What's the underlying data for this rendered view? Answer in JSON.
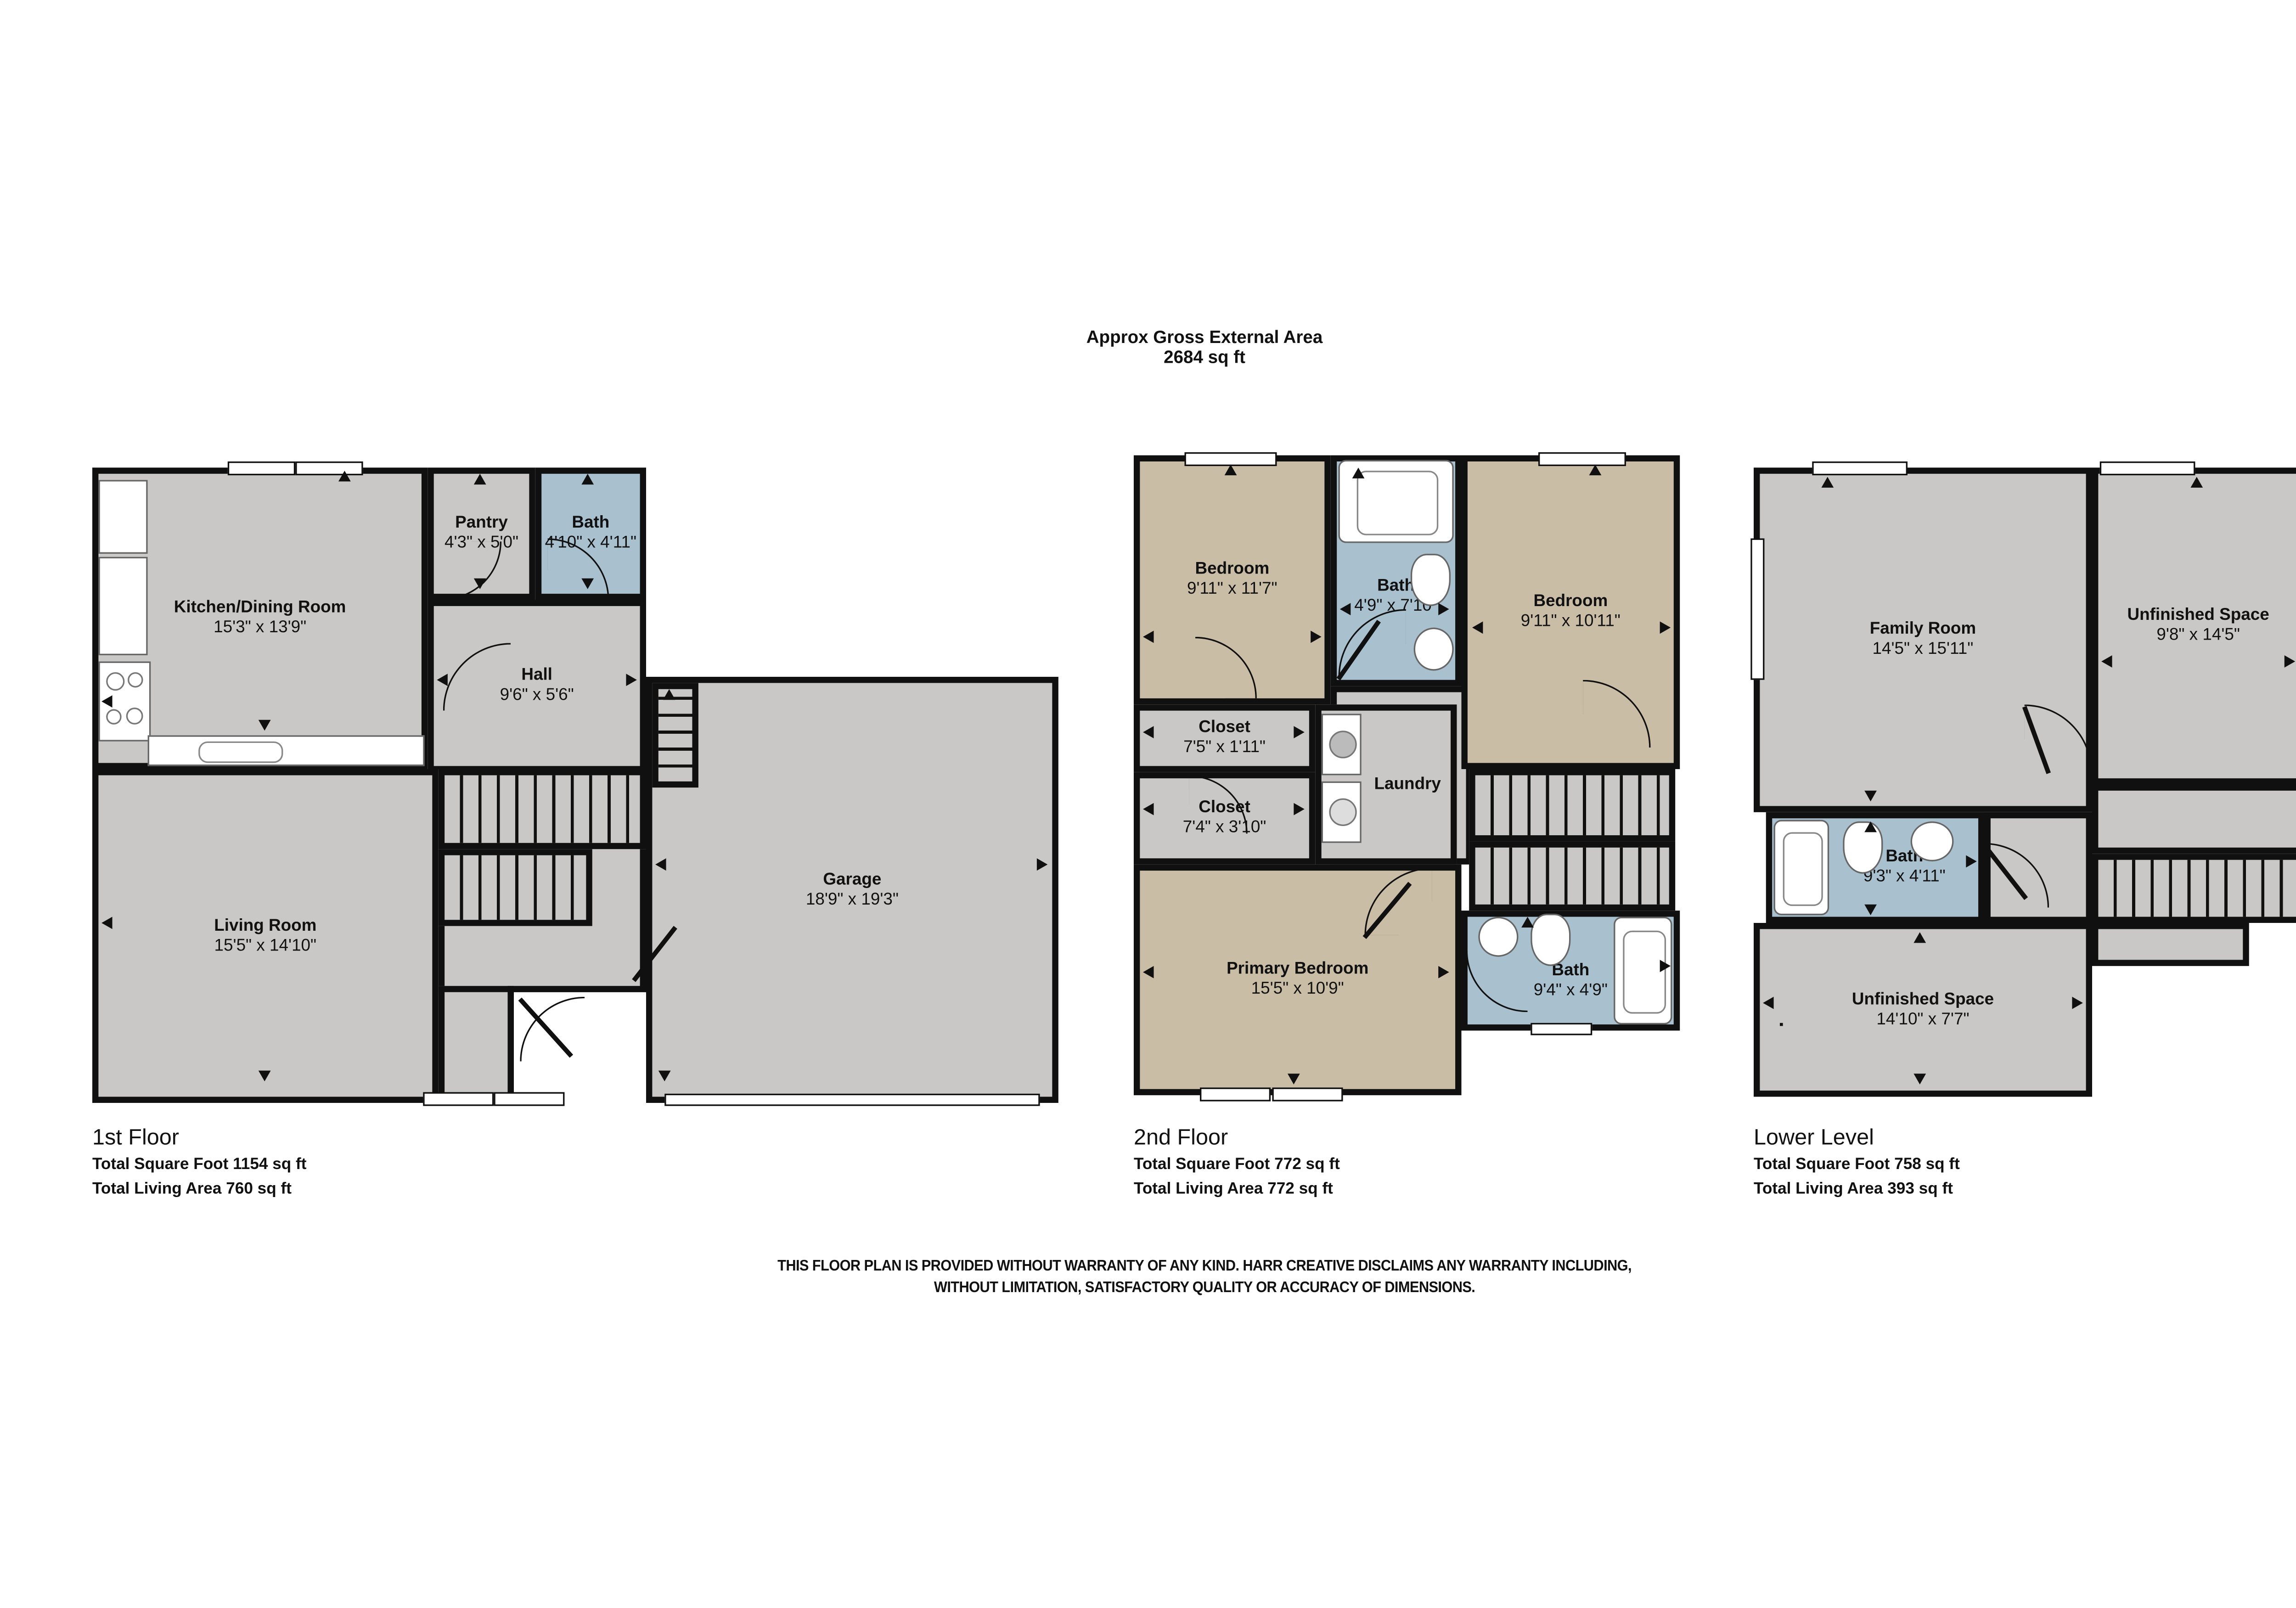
{
  "title": {
    "line1": "Approx Gross External Area",
    "line2": "2684 sq ft"
  },
  "disclaimer": {
    "line1": "THIS FLOOR PLAN IS PROVIDED WITHOUT WARRANTY OF ANY KIND. HARR CREATIVE DISCLAIMS ANY WARRANTY INCLUDING,",
    "line2": "WITHOUT LIMITATION, SATISFACTORY QUALITY OR ACCURACY OF DIMENSIONS."
  },
  "colors": {
    "wall": "#101010",
    "room_gray": "#c9c8c6",
    "room_tan": "#c9bda6",
    "room_blue": "#a9c0ce",
    "window_white": "#ffffff"
  },
  "floors": [
    {
      "name": "1st Floor",
      "total_sqft": "Total Square Foot 1154 sq ft",
      "living_area": "Total Living Area 760 sq ft",
      "rooms": {
        "kitchen": {
          "label": "Kitchen/Dining Room",
          "dims": "15'3\" x 13'9\""
        },
        "pantry": {
          "label": "Pantry",
          "dims": "4'3\" x 5'0\""
        },
        "bath": {
          "label": "Bath",
          "dims": "4'10\" x 4'11\""
        },
        "hall": {
          "label": "Hall",
          "dims": "9'6\" x 5'6\""
        },
        "living": {
          "label": "Living Room",
          "dims": "15'5\" x 14'10\""
        },
        "garage": {
          "label": "Garage",
          "dims": "18'9\" x 19'3\""
        }
      }
    },
    {
      "name": "2nd Floor",
      "total_sqft": "Total Square Foot 772 sq ft",
      "living_area": "Total Living Area 772 sq ft",
      "rooms": {
        "bedroom_left": {
          "label": "Bedroom",
          "dims": "9'11\" x 11'7\""
        },
        "bath_top": {
          "label": "Bath",
          "dims": "4'9\" x 7'10\""
        },
        "bedroom_right": {
          "label": "Bedroom",
          "dims": "9'11\" x 10'11\""
        },
        "closet_top": {
          "label": "Closet",
          "dims": "7'5\" x 1'11\""
        },
        "closet_bottom": {
          "label": "Closet",
          "dims": "7'4\" x 3'10\""
        },
        "laundry": {
          "label": "Laundry"
        },
        "primary": {
          "label": "Primary Bedroom",
          "dims": "15'5\" x 10'9\""
        },
        "bath_bottom": {
          "label": "Bath",
          "dims": "9'4\" x 4'9\""
        }
      }
    },
    {
      "name": "Lower Level",
      "total_sqft": "Total Square Foot 758 sq ft",
      "living_area": "Total Living Area 393 sq ft",
      "rooms": {
        "family": {
          "label": "Family Room",
          "dims": "14'5\" x 15'11\""
        },
        "unfinished_top": {
          "label": "Unfinished Space",
          "dims": "9'8\" x 14'5\""
        },
        "bath": {
          "label": "Bath",
          "dims": "9'3\" x 4'11\""
        },
        "unfinished_bottom": {
          "label": "Unfinished Space",
          "dims": "14'10\" x 7'7\""
        }
      }
    }
  ]
}
